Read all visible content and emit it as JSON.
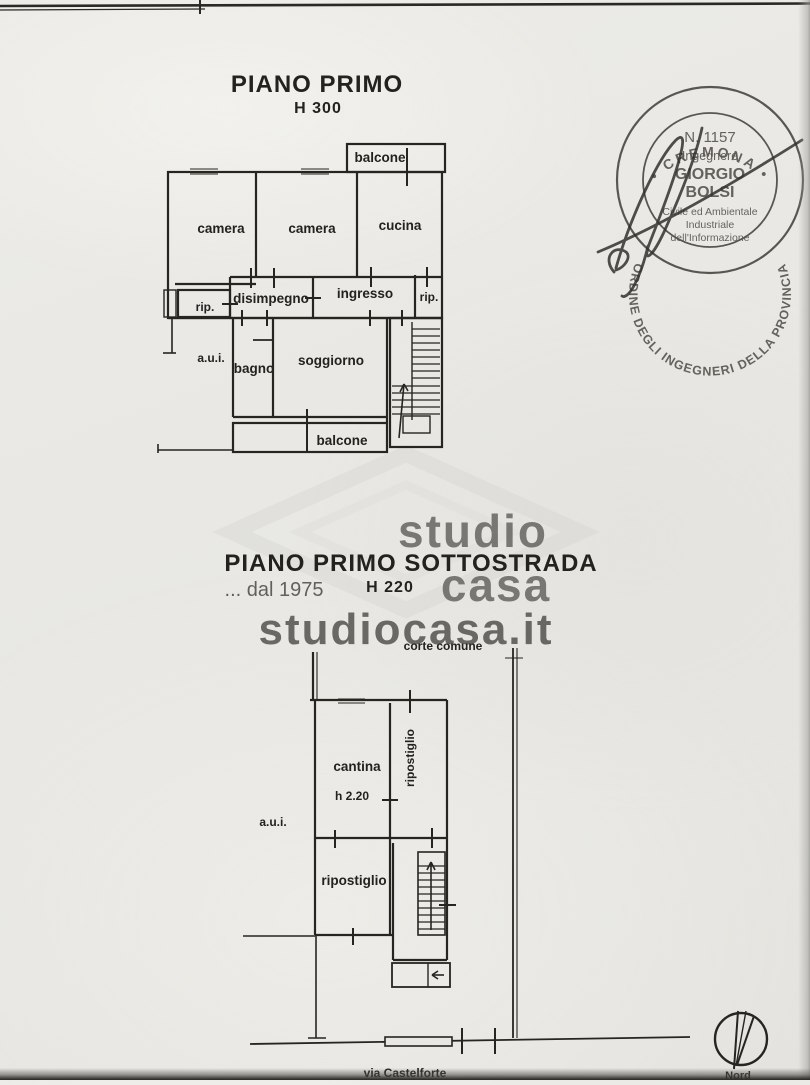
{
  "titles": {
    "plan1": "PIANO PRIMO",
    "plan1_height": "H 300",
    "plan2": "PIANO PRIMO SOTTOSTRADA",
    "plan2_height": "H 220"
  },
  "plan1_rooms": {
    "balcone_top": "balcone",
    "camera_left": "camera",
    "camera_mid": "camera",
    "cucina": "cucina",
    "rip_left": "rip.",
    "disimpegno": "disimpegno",
    "ingresso": "ingresso",
    "rip_right": "rip.",
    "aui": "a.u.i.",
    "bagno": "bagno",
    "soggiorno": "soggiorno",
    "balcone_bottom": "balcone"
  },
  "plan2_labels": {
    "corte": "corte comune",
    "cantina": "cantina",
    "cantina_height": "h 2.20",
    "ripostiglio_side": "ripostiglio",
    "aui": "a.u.i.",
    "ripostiglio_lower": "ripostiglio",
    "street": "via Castelforte"
  },
  "compass": {
    "label": "Nord"
  },
  "watermark": {
    "brand_word1": "studio",
    "brand_word2": "casa",
    "since": "... dal 1975",
    "website": "studiocasa.it"
  },
  "stamp": {
    "ring_text": "ORDINE DEGLI INGEGNERI DELLA PROVINCIA",
    "ring_bottom": "• CREMONA •",
    "number": "N. 1157",
    "role": "Ingegnere",
    "name": "GIORGIO",
    "surname": "BOLSI",
    "sections": {
      "s1": "Civile ed Ambientale",
      "s2": "Industriale",
      "s3": "dell'Informazione"
    }
  },
  "colors": {
    "paper": "#e8e7e3",
    "ink": "#23221f",
    "stamp_ink": "#4a4741",
    "watermark_gray": "#c7c6c2"
  }
}
